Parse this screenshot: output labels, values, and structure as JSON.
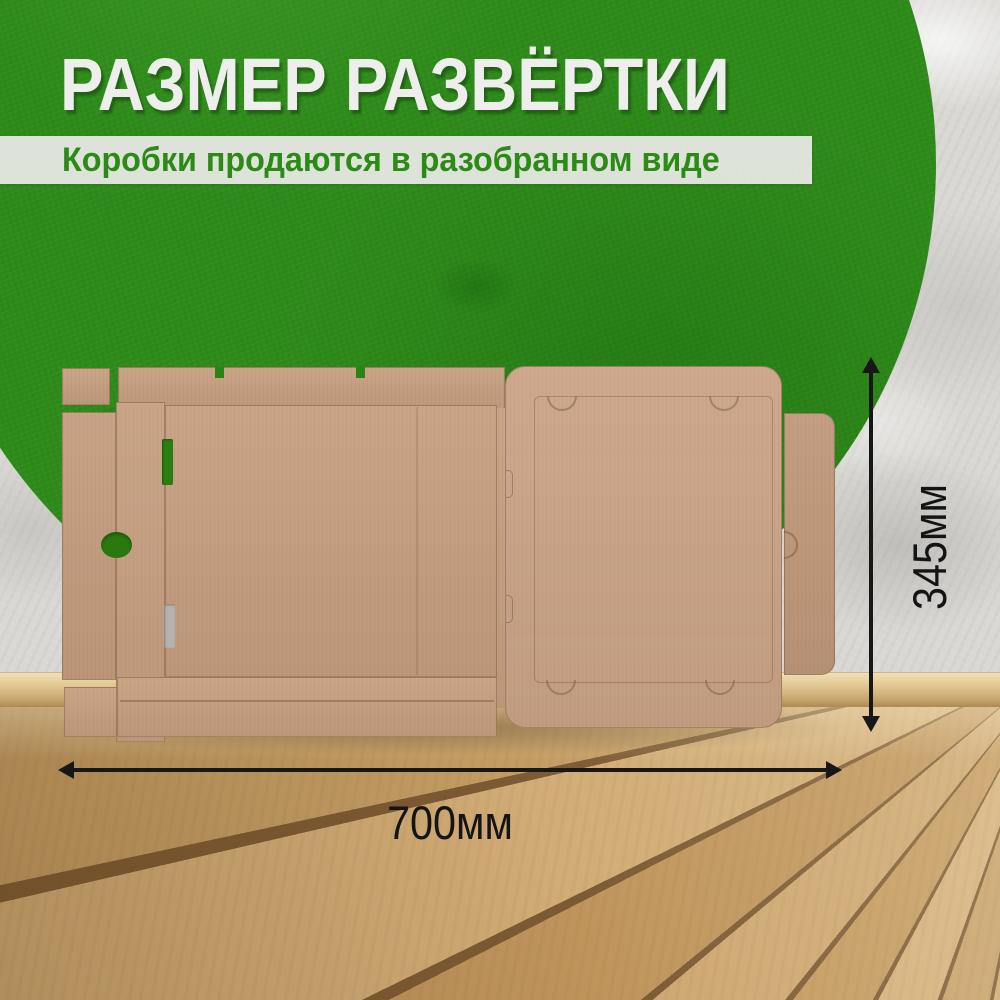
{
  "header": {
    "title": "РАЗМЕР РАЗВЁРТКИ",
    "subtitle": "Коробки продаются в разобранном виде"
  },
  "dimensions": {
    "width": "700мм",
    "height": "345мм"
  },
  "scene_objects": {
    "box": "flattened-cardboard-pizza-box-blank",
    "background": "green-circle-on-plaster-wall",
    "floor": "wooden-plank-floor"
  },
  "colors": {
    "accent_green": "#2e8b1a",
    "title_text": "#eeefed",
    "subtitle_bar": "#ebeae7",
    "subtitle_text": "#2c8a17",
    "cardboard": "#c79f80",
    "wall": "#d9d8d4",
    "floor_wood": "#c6a06a",
    "dimension_text": "#141414"
  }
}
